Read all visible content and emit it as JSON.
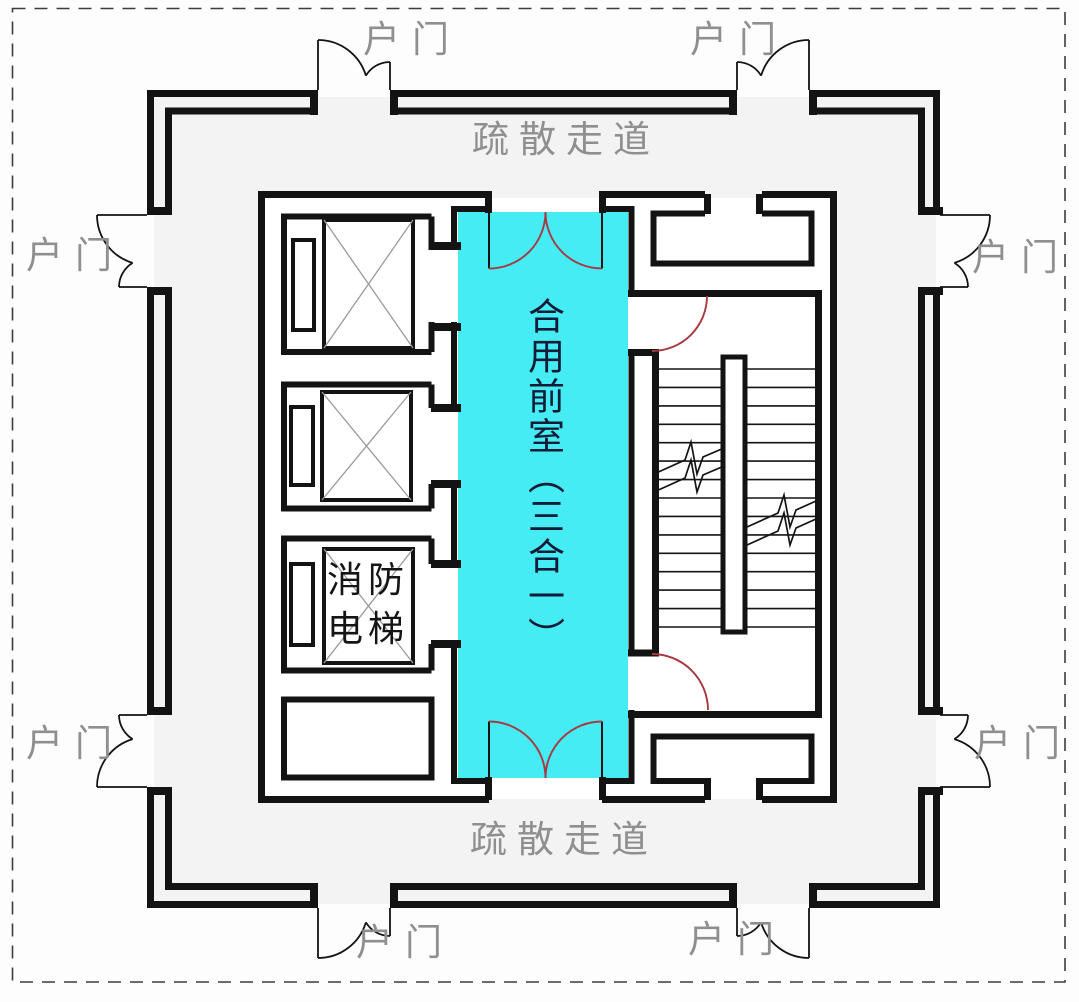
{
  "labels": {
    "unit_door": "户门",
    "evac_corridor": "疏散走道",
    "front_room": "合用前室（三合一）",
    "fire_elevator_line1": "消防",
    "fire_elevator_line2": "电梯"
  },
  "colors": {
    "highlight_cyan": "#45ecf4",
    "door_arc_red": "#a83842",
    "wall_black": "#131313",
    "floor_gray": "#f3f3f3",
    "label_gray": "#8f8f8f",
    "front_room_text_navy": "#131c36"
  }
}
